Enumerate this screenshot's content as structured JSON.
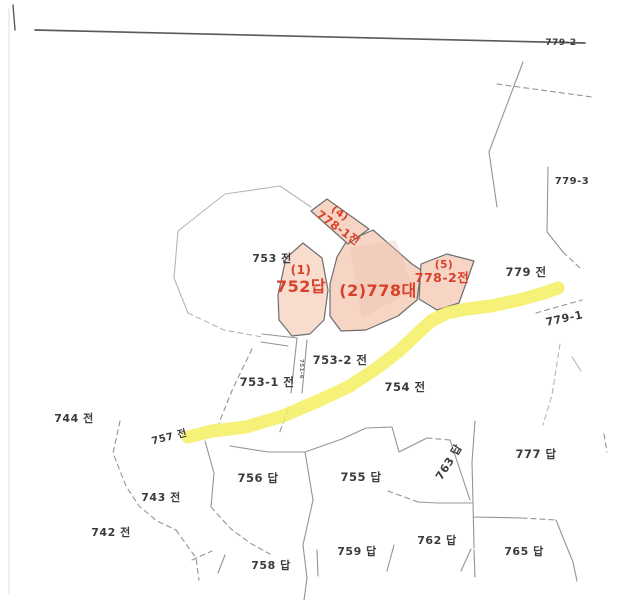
{
  "page": {
    "type": "scanned-cadastral-map",
    "description_labels_visible_only": true
  },
  "colors": {
    "background": "#ffffff",
    "top_rule": "#5a5a5a",
    "boundary_line": "#949494",
    "faint_line": "#b5b5b5",
    "edge_line": "#e2e2e2",
    "parcel_border": "#6e6e6e",
    "highlight_parcel_fill": "#f6d5c5",
    "highlight_parcel_fill_light": "#f8dccd",
    "highlight_parcel_shade": "#eec0ab",
    "road_highlight": "#f4ee56",
    "red_label": "#d8402c",
    "black_label": "#3b3b3b",
    "dim_label": "#6e6e6e"
  },
  "map": {
    "width": 619,
    "height": 600,
    "road": {
      "name": "road-highlight-779-1",
      "width": 13,
      "opacity": 0.8,
      "points": [
        [
          188,
          437
        ],
        [
          212,
          431
        ],
        [
          246,
          427
        ],
        [
          283,
          416
        ],
        [
          318,
          401
        ],
        [
          350,
          386
        ],
        [
          377,
          368
        ],
        [
          399,
          351
        ],
        [
          417,
          334
        ],
        [
          431,
          321
        ],
        [
          447,
          313
        ],
        [
          467,
          309
        ],
        [
          491,
          306
        ],
        [
          519,
          300
        ],
        [
          544,
          293
        ],
        [
          558,
          288
        ]
      ]
    },
    "highlight_parcels": [
      {
        "name": "parcel-752",
        "fill": "#f8dccd",
        "points": [
          [
            303,
            243
          ],
          [
            286,
            258
          ],
          [
            278,
            295
          ],
          [
            279,
            320
          ],
          [
            292,
            336
          ],
          [
            310,
            334
          ],
          [
            324,
            320
          ],
          [
            328,
            290
          ],
          [
            322,
            258
          ]
        ]
      },
      {
        "name": "parcel-778",
        "fill": "#f6d5c5",
        "points": [
          [
            346,
            242
          ],
          [
            373,
            230
          ],
          [
            412,
            264
          ],
          [
            421,
            270
          ],
          [
            417,
            300
          ],
          [
            398,
            316
          ],
          [
            366,
            330
          ],
          [
            341,
            331
          ],
          [
            330,
            316
          ],
          [
            330,
            284
          ],
          [
            337,
            257
          ]
        ]
      },
      {
        "name": "parcel-778-1",
        "fill": "#f6d5c5",
        "points": [
          [
            311,
            211
          ],
          [
            327,
            199
          ],
          [
            369,
            229
          ],
          [
            348,
            244
          ]
        ]
      },
      {
        "name": "parcel-778-2",
        "fill": "#f6d5c5",
        "points": [
          [
            421,
            264
          ],
          [
            447,
            254
          ],
          [
            474,
            261
          ],
          [
            459,
            303
          ],
          [
            437,
            310
          ],
          [
            419,
            299
          ]
        ]
      }
    ],
    "parcel_shade": {
      "name": "parcel-778-shade",
      "fill": "#eec0ab",
      "opacity": 0.35,
      "points": [
        [
          350,
          248
        ],
        [
          396,
          240
        ],
        [
          414,
          290
        ],
        [
          362,
          318
        ]
      ]
    },
    "boundary_lines": [
      {
        "points": [
          [
            35,
            30
          ],
          [
            585,
            43
          ]
        ],
        "stroke": "#5a5a5a",
        "width": 1.7
      },
      {
        "points": [
          [
            13,
            5
          ],
          [
            15,
            30
          ]
        ],
        "stroke": "#5a5a5a",
        "width": 1.4
      },
      {
        "points": [
          [
            9,
            8
          ],
          [
            9,
            594
          ]
        ],
        "stroke": "#e2e2e2",
        "width": 1
      },
      {
        "points": [
          [
            497,
            84
          ],
          [
            592,
            97
          ]
        ],
        "dashed": true
      },
      {
        "points": [
          [
            523,
            62
          ],
          [
            489,
            152
          ],
          [
            497,
            207
          ]
        ]
      },
      {
        "points": [
          [
            548,
            167
          ],
          [
            547,
            232
          ],
          [
            563,
            252
          ]
        ]
      },
      {
        "points": [
          [
            563,
            252
          ],
          [
            580,
            268
          ]
        ],
        "dashed": true
      },
      {
        "points": [
          [
            536,
            313
          ],
          [
            582,
            300
          ]
        ],
        "dashed": true
      },
      {
        "points": [
          [
            178,
            231
          ],
          [
            225,
            194
          ],
          [
            280,
            186
          ],
          [
            311,
            207
          ]
        ],
        "stroke": "#b5b5b5"
      },
      {
        "points": [
          [
            178,
            231
          ],
          [
            174,
            278
          ],
          [
            188,
            313
          ]
        ],
        "stroke": "#b5b5b5"
      },
      {
        "points": [
          [
            188,
            313
          ],
          [
            224,
            330
          ],
          [
            262,
            337
          ]
        ],
        "dashed": true,
        "stroke": "#b5b5b5"
      },
      {
        "points": [
          [
            262,
            334
          ],
          [
            297,
            338
          ]
        ]
      },
      {
        "points": [
          [
            261,
            342
          ],
          [
            288,
            346
          ]
        ]
      },
      {
        "points": [
          [
            297,
            338
          ],
          [
            291,
            393
          ]
        ]
      },
      {
        "points": [
          [
            307,
            340
          ],
          [
            302,
            393
          ]
        ]
      },
      {
        "points": [
          [
            288,
            410
          ],
          [
            279,
            434
          ]
        ],
        "dashed": true
      },
      {
        "points": [
          [
            252,
            349
          ],
          [
            233,
            388
          ],
          [
            219,
            423
          ]
        ],
        "dashed": true
      },
      {
        "points": [
          [
            120,
            421
          ],
          [
            113,
            453
          ],
          [
            126,
            486
          ],
          [
            139,
            506
          ],
          [
            157,
            521
          ],
          [
            176,
            530
          ]
        ],
        "dashed": true
      },
      {
        "points": [
          [
            176,
            530
          ],
          [
            196,
            558
          ],
          [
            199,
            580
          ]
        ],
        "dashed": true
      },
      {
        "points": [
          [
            205,
            441
          ],
          [
            214,
            473
          ],
          [
            211,
            507
          ]
        ]
      },
      {
        "points": [
          [
            211,
            507
          ],
          [
            231,
            529
          ],
          [
            250,
            543
          ],
          [
            270,
            554
          ]
        ],
        "dashed": true
      },
      {
        "points": [
          [
            192,
            560
          ],
          [
            212,
            551
          ]
        ],
        "dashed": true
      },
      {
        "points": [
          [
            225,
            555
          ],
          [
            218,
            573
          ]
        ]
      },
      {
        "points": [
          [
            230,
            446
          ],
          [
            268,
            452
          ],
          [
            305,
            452
          ],
          [
            342,
            439
          ],
          [
            366,
            428
          ],
          [
            392,
            427
          ],
          [
            399,
            452
          ],
          [
            427,
            438
          ]
        ]
      },
      {
        "points": [
          [
            427,
            438
          ],
          [
            450,
            440
          ]
        ],
        "dashed": true
      },
      {
        "points": [
          [
            305,
            452
          ],
          [
            313,
            500
          ],
          [
            303,
            545
          ],
          [
            307,
            578
          ],
          [
            304,
            600
          ]
        ]
      },
      {
        "points": [
          [
            475,
            421
          ],
          [
            472,
            462
          ],
          [
            473,
            502
          ],
          [
            474,
            548
          ]
        ]
      },
      {
        "points": [
          [
            450,
            440
          ],
          [
            459,
            467
          ],
          [
            470,
            500
          ]
        ]
      },
      {
        "points": [
          [
            472,
            503
          ],
          [
            438,
            503
          ],
          [
            418,
            502
          ]
        ]
      },
      {
        "points": [
          [
            418,
            502
          ],
          [
            388,
            491
          ]
        ],
        "dashed": true
      },
      {
        "points": [
          [
            474,
            517
          ],
          [
            522,
            518
          ]
        ]
      },
      {
        "points": [
          [
            522,
            518
          ],
          [
            556,
            520
          ]
        ],
        "dashed": true
      },
      {
        "points": [
          [
            556,
            520
          ],
          [
            564,
            540
          ],
          [
            573,
            562
          ]
        ]
      },
      {
        "points": [
          [
            471,
            549
          ],
          [
            461,
            571
          ]
        ]
      },
      {
        "points": [
          [
            474,
            550
          ],
          [
            475,
            577
          ]
        ]
      },
      {
        "points": [
          [
            317,
            550
          ],
          [
            318,
            576
          ]
        ]
      },
      {
        "points": [
          [
            394,
            545
          ],
          [
            387,
            571
          ]
        ]
      },
      {
        "points": [
          [
            560,
            344
          ],
          [
            552,
            395
          ],
          [
            543,
            425
          ]
        ],
        "dashed": true,
        "stroke": "#b5b5b5"
      },
      {
        "points": [
          [
            604,
            434
          ],
          [
            607,
            452
          ]
        ],
        "dashed": true
      },
      {
        "points": [
          [
            572,
            357
          ],
          [
            581,
            371
          ]
        ],
        "stroke": "#b5b5b5"
      },
      {
        "points": [
          [
            573,
            562
          ],
          [
            577,
            581
          ]
        ]
      }
    ],
    "labels": [
      {
        "name": "label-779-2",
        "text": "779-2",
        "x": 561,
        "y": 45,
        "size": 9,
        "kind": "black"
      },
      {
        "name": "label-779-3",
        "text": "779-3",
        "x": 572,
        "y": 184,
        "size": 10,
        "kind": "black"
      },
      {
        "name": "label-753",
        "text": "753 전",
        "x": 272,
        "y": 262,
        "size": 11,
        "kind": "black"
      },
      {
        "name": "label-779",
        "text": "779 전",
        "x": 526,
        "y": 276,
        "size": 11.5,
        "kind": "black"
      },
      {
        "name": "label-779-1",
        "text": "779-1",
        "x": 565,
        "y": 322,
        "size": 11,
        "kind": "black",
        "rotate": -12
      },
      {
        "name": "label-753-2",
        "text": "753-2 전",
        "x": 340,
        "y": 364,
        "size": 11.5,
        "kind": "black"
      },
      {
        "name": "label-753-1",
        "text": "753-1 전",
        "x": 267,
        "y": 386,
        "size": 11.5,
        "kind": "black"
      },
      {
        "name": "label-754",
        "text": "754 전",
        "x": 405,
        "y": 391,
        "size": 11.5,
        "kind": "black"
      },
      {
        "name": "label-744",
        "text": "744 전",
        "x": 74,
        "y": 422,
        "size": 11,
        "kind": "black"
      },
      {
        "name": "label-757",
        "text": "757 전",
        "x": 170,
        "y": 440,
        "size": 10,
        "kind": "black",
        "rotate": -14
      },
      {
        "name": "label-756",
        "text": "756 답",
        "x": 258,
        "y": 482,
        "size": 11.5,
        "kind": "black"
      },
      {
        "name": "label-755",
        "text": "755 답",
        "x": 361,
        "y": 481,
        "size": 11.5,
        "kind": "black"
      },
      {
        "name": "label-763",
        "text": "763 답",
        "x": 452,
        "y": 464,
        "size": 11,
        "kind": "black",
        "rotate": -58
      },
      {
        "name": "label-777",
        "text": "777 답",
        "x": 536,
        "y": 458,
        "size": 11.5,
        "kind": "black"
      },
      {
        "name": "label-743",
        "text": "743 전",
        "x": 161,
        "y": 501,
        "size": 11,
        "kind": "black"
      },
      {
        "name": "label-742",
        "text": "742 전",
        "x": 111,
        "y": 536,
        "size": 11,
        "kind": "black"
      },
      {
        "name": "label-759",
        "text": "759 답",
        "x": 357,
        "y": 555,
        "size": 11,
        "kind": "black"
      },
      {
        "name": "label-762",
        "text": "762 답",
        "x": 437,
        "y": 544,
        "size": 11,
        "kind": "black"
      },
      {
        "name": "label-765",
        "text": "765 답",
        "x": 524,
        "y": 555,
        "size": 11,
        "kind": "black"
      },
      {
        "name": "label-758",
        "text": "758 답",
        "x": 271,
        "y": 569,
        "size": 11,
        "kind": "black"
      },
      {
        "name": "label-751-6-strip",
        "text": "751-6",
        "x": 300,
        "y": 369,
        "size": 5.5,
        "kind": "dim",
        "rotate": 90
      },
      {
        "name": "label-778-1-no",
        "text": "(4)",
        "x": 338,
        "y": 216,
        "size": 10.5,
        "kind": "red",
        "rotate": 36
      },
      {
        "name": "label-778-1",
        "text": "778-1전",
        "x": 336,
        "y": 231,
        "size": 11.5,
        "kind": "red",
        "rotate": 36
      },
      {
        "name": "label-752-no",
        "text": "(1)",
        "x": 301,
        "y": 274,
        "size": 12,
        "kind": "red"
      },
      {
        "name": "label-752",
        "text": "752답",
        "x": 301,
        "y": 292,
        "size": 16,
        "kind": "red"
      },
      {
        "name": "label-778",
        "text": "(2)778대",
        "x": 378,
        "y": 296,
        "size": 16,
        "kind": "red"
      },
      {
        "name": "label-778-2-no",
        "text": "(5)",
        "x": 444,
        "y": 268,
        "size": 10.5,
        "kind": "red"
      },
      {
        "name": "label-778-2",
        "text": "778-2전",
        "x": 442,
        "y": 282,
        "size": 12.5,
        "kind": "red"
      }
    ]
  }
}
